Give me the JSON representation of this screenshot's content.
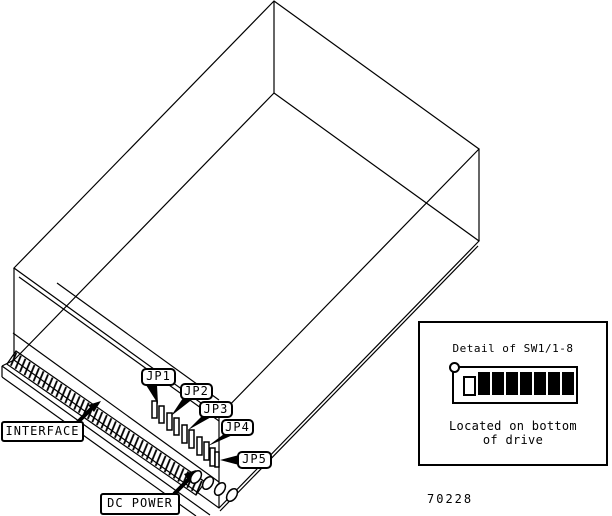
{
  "figure": {
    "callouts": {
      "jp1": "JP1",
      "jp2": "JP2",
      "jp3": "JP3",
      "jp4": "JP4",
      "jp5": "JP5",
      "interface": "INTERFACE",
      "dc_power": "DC POWER"
    },
    "detail_inset": {
      "title": "Detail of SW1/1-8",
      "caption_line1": "Located on bottom",
      "caption_line2": "of drive",
      "dip_switch": {
        "count": 8,
        "states": [
          "open",
          "closed",
          "closed",
          "closed",
          "closed",
          "closed",
          "closed",
          "closed"
        ]
      }
    },
    "figure_number": "70228",
    "colors": {
      "line": "#000000",
      "background": "#ffffff"
    }
  }
}
